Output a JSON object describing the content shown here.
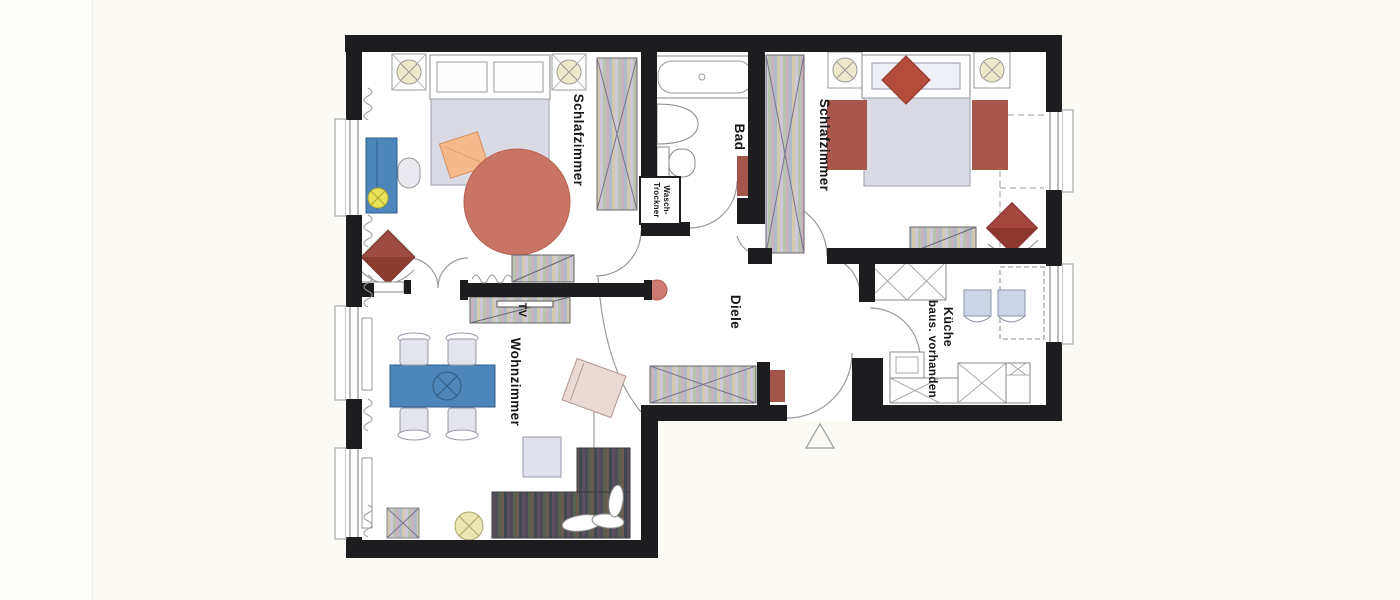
{
  "plan": {
    "labels": {
      "bedroom1": "Schlafzimmer",
      "bedroom2": "Schlafzimmer",
      "bath": "Bad",
      "washer_line1": "Wasch-",
      "washer_line2": "Trockner",
      "hall": "Diele",
      "living": "Wohnzimmer",
      "tv": "TV",
      "kitchen_line1": "Küche",
      "kitchen_line2": "baus. vorhanden"
    },
    "colors": {
      "wall": "#1d1d1f",
      "floor": "#ffffff",
      "line": "#8a8a8a",
      "round_rug": "#c97565",
      "red_rug": "#a9574b",
      "red_mat": "#a5564a",
      "red_chair": "#9d4b41",
      "red_chair2": "#a5473c",
      "red_pillow": "#b44c3e",
      "red_dot": "#cd7b72",
      "desk_blue": "#4d86bb",
      "table_blue": "#4d86bb",
      "lamp_yellow": "#e8e159",
      "lamp_cream": "#efe9cb",
      "lamp_round": "#eae7b4",
      "mattress": "#dadae4",
      "orange_pillow": "#f5b98b",
      "armchair": "#ead9d4",
      "kitchen_chair": "#ccd4e8",
      "coffee_table": "#dfe2ec",
      "dining_chair": "#e4e4ec"
    }
  }
}
